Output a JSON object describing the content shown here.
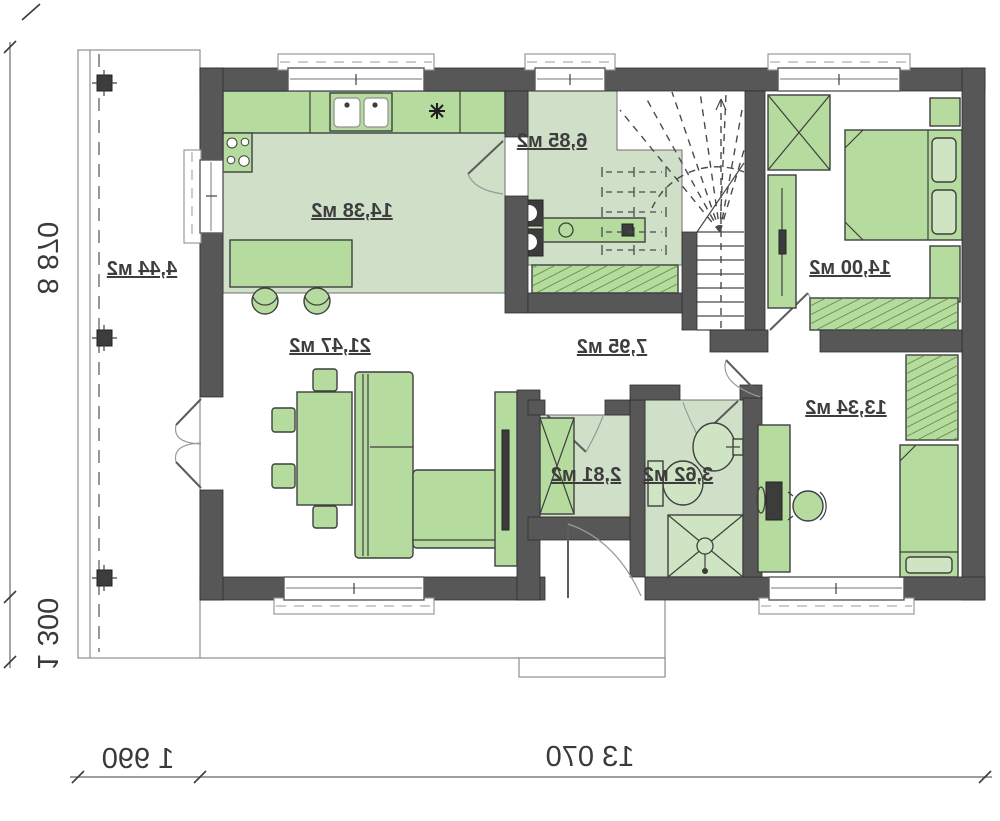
{
  "plan": {
    "type": "floor-plan",
    "mirrored_text": true,
    "rooms": {
      "kitchen": {
        "name": "kitchen-dining",
        "area_label": "14,38 м2"
      },
      "utility": {
        "name": "utility-pantry",
        "area_label": "6,85 м2"
      },
      "bedroom_top": {
        "name": "bedroom-1",
        "area_label": "14,00 м2"
      },
      "living": {
        "name": "living-room",
        "area_label": "21,47 м2"
      },
      "hall": {
        "name": "hallway",
        "area_label": "7,95 м2"
      },
      "closet": {
        "name": "wardrobe-closet",
        "area_label": "2,81 м2"
      },
      "bathroom": {
        "name": "bathroom",
        "area_label": "3,62 м2"
      },
      "bedroom_bottom": {
        "name": "bedroom-2",
        "area_label": "13,34 м2"
      },
      "terrace": {
        "name": "terrace",
        "area_label": "4,44 м2"
      }
    },
    "dimensions": {
      "left_main": "8 870",
      "left_lower": "1 300",
      "bottom_main": "13 070",
      "bottom_left": "1 990"
    },
    "colors": {
      "wall": "#575757",
      "floor_green": "#cfdfc8",
      "furniture_green": "#b5db9e",
      "hatch_green": "#57873f",
      "dimension_text": "#3a3a3a",
      "background": "#ffffff"
    }
  }
}
